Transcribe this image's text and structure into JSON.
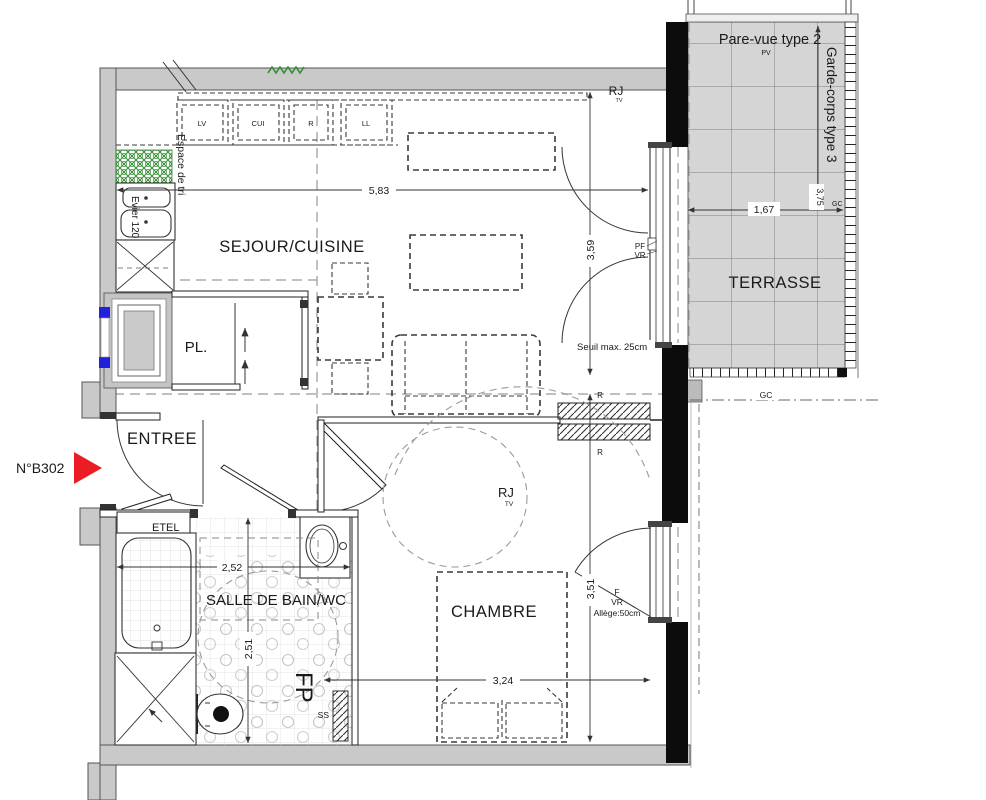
{
  "unit": {
    "number": "N°B302"
  },
  "rooms": {
    "living": "SEJOUR/CUISINE",
    "bedroom": "CHAMBRE",
    "bathroom": "SALLE DE BAIN/WC",
    "entrance": "ENTREE",
    "closet": "PL.",
    "terrace": "TERRASSE",
    "etel": "ETEL"
  },
  "kitchen": {
    "dishwasher": "LV",
    "cooker": "CUI",
    "fridge": "R",
    "washer": "LL",
    "sorting_area": "Espace de tri",
    "sink": "Evier 120"
  },
  "dimensions": {
    "living_width": "5,83",
    "living_depth": "3,59",
    "bedroom_depth": "3,51",
    "bedroom_width": "3,24",
    "bathroom_width": "2,52",
    "bathroom_depth": "2,51",
    "terrace_width": "1,67",
    "terrace_depth": "3,75"
  },
  "terrace": {
    "screen": "Pare-vue type 2",
    "screen_abbr": "PV",
    "railing": "Garde-corps type 3",
    "gc_side": "GC",
    "gc_line": "GC"
  },
  "labels": {
    "rj_living": "RJ",
    "rj_living_sub": "TV",
    "rj_bedroom": "RJ",
    "rj_bedroom_sub": "TV",
    "threshold": "Seuil max. 25cm",
    "pf": "PF",
    "vr_living": "VR",
    "f": "F",
    "vr_bedroom": "VR",
    "sill": "Allège:50cm",
    "r_top": "R",
    "r_bottom": "R",
    "fp": "FP",
    "ss": "SS"
  }
}
